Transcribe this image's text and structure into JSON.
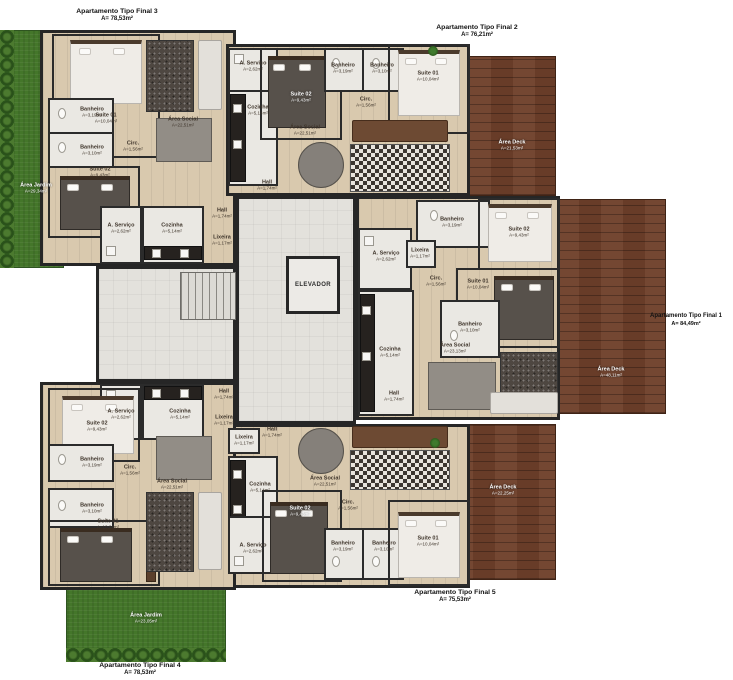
{
  "captions": {
    "final3": {
      "title": "Apartamento Tipo Final 3",
      "area": "A= 78,53m²"
    },
    "final2": {
      "title": "Apartamento Tipo Final 2",
      "area": "A= 76,21m²"
    },
    "final1": {
      "title": "Apartamento Tipo Final 1",
      "area": "A= 84,49m²"
    },
    "final5": {
      "title": "Apartamento Tipo Final 5",
      "area": "A= 75,53m²"
    },
    "final4": {
      "title": "Apartamento Tipo Final 4",
      "area": "A= 78,53m²"
    }
  },
  "outdoor": {
    "garden_left": {
      "label": "Área Jardim",
      "area": "A=29,34m²"
    },
    "garden_bottom": {
      "label": "Área Jardim",
      "area": "A=23,05m²"
    },
    "deck_top": {
      "label": "Área Deck",
      "area": "A=21,53m²"
    },
    "deck_right": {
      "label": "Área Deck",
      "area": "A=48,11m²"
    },
    "deck_bottom": {
      "label": "Área Deck",
      "area": "A=22,25m²"
    }
  },
  "core": {
    "elevator": "ELEVADOR"
  },
  "rooms": {
    "final3": {
      "suite01": {
        "name": "Suíte 01",
        "area": "A=10,04m²"
      },
      "banheiro_a": {
        "name": "Banheiro",
        "area": "A=3,19m²"
      },
      "banheiro_b": {
        "name": "Banheiro",
        "area": "A=3,10m²"
      },
      "suite02": {
        "name": "Suíte 02",
        "area": "A=9,43m²"
      },
      "circ": {
        "name": "Circ.",
        "area": "A=1,56m²"
      },
      "aservico": {
        "name": "A. Serviço",
        "area": "A=2,62m²"
      },
      "cozinha": {
        "name": "Cozinha",
        "area": "A=5,14m²"
      },
      "hall": {
        "name": "Hall",
        "area": "A=1,74m²"
      },
      "lixeira": {
        "name": "Lixeira",
        "area": "A=1,17m²"
      },
      "social": {
        "name": "Área Social",
        "area": "A=22,51m²"
      }
    },
    "final2": {
      "aservico": {
        "name": "A. Serviço",
        "area": "A=2,62m²"
      },
      "cozinha": {
        "name": "Cozinha",
        "area": "A=5,14m²"
      },
      "suite02": {
        "name": "Suíte 02",
        "area": "A=9,43m²"
      },
      "banheiro_a": {
        "name": "Banheiro",
        "area": "A=3,19m²"
      },
      "banheiro_b": {
        "name": "Banheiro",
        "area": "A=3,10m²"
      },
      "circ": {
        "name": "Circ.",
        "area": "A=1,56m²"
      },
      "social": {
        "name": "Área Social",
        "area": "A=22,51m²"
      },
      "suite01": {
        "name": "Suíte 01",
        "area": "A=10,04m²"
      },
      "hall": {
        "name": "Hall",
        "area": "A=1,74m²"
      }
    },
    "final1": {
      "banheiro_a": {
        "name": "Banheiro",
        "area": "A=3,19m²"
      },
      "suite02": {
        "name": "Suíte 02",
        "area": "A=9,43m²"
      },
      "aservico": {
        "name": "A. Serviço",
        "area": "A=2,62m²"
      },
      "lixeira": {
        "name": "Lixeira",
        "area": "A=1,17m²"
      },
      "circ": {
        "name": "Circ.",
        "area": "A=1,56m²"
      },
      "suite01": {
        "name": "Suíte 01",
        "area": "A=10,04m²"
      },
      "cozinha": {
        "name": "Cozinha",
        "area": "A=5,14m²"
      },
      "banheiro_b": {
        "name": "Banheiro",
        "area": "A=3,10m²"
      },
      "social": {
        "name": "Área Social",
        "area": "A=23,13m²"
      },
      "hall": {
        "name": "Hall",
        "area": "A=1,74m²"
      }
    },
    "final5": {
      "hall": {
        "name": "Hall",
        "area": "A=1,74m²"
      },
      "lixeira": {
        "name": "Lixeira",
        "area": "A=1,17m²"
      },
      "cozinha": {
        "name": "Cozinha",
        "area": "A=5,14m²"
      },
      "social": {
        "name": "Área Social",
        "area": "A=22,51m²"
      },
      "aservico": {
        "name": "A. Serviço",
        "area": "A=2,62m²"
      },
      "suite02": {
        "name": "Suíte 02",
        "area": "A=9,43m²"
      },
      "circ": {
        "name": "Circ.",
        "area": "A=1,56m²"
      },
      "banheiro_a": {
        "name": "Banheiro",
        "area": "A=3,19m²"
      },
      "banheiro_b": {
        "name": "Banheiro",
        "area": "A=3,10m²"
      },
      "suite01": {
        "name": "Suíte 01",
        "area": "A=10,04m²"
      }
    },
    "final4": {
      "aservico": {
        "name": "A. Serviço",
        "area": "A=2,62m²"
      },
      "cozinha": {
        "name": "Cozinha",
        "area": "A=5,14m²"
      },
      "hall": {
        "name": "Hall",
        "area": "A=1,74m²"
      },
      "lixeira": {
        "name": "Lixeira",
        "area": "A=1,17m²"
      },
      "suite02": {
        "name": "Suíte 02",
        "area": "A=9,43m²"
      },
      "banheiro_a": {
        "name": "Banheiro",
        "area": "A=3,19m²"
      },
      "banheiro_b": {
        "name": "Banheiro",
        "area": "A=3,10m²"
      },
      "suite01": {
        "name": "Suíte 01",
        "area": "A=10,04m²"
      },
      "circ": {
        "name": "Circ.",
        "area": "A=1,56m²"
      },
      "social": {
        "name": "Área Social",
        "area": "A=22,51m²"
      }
    }
  }
}
